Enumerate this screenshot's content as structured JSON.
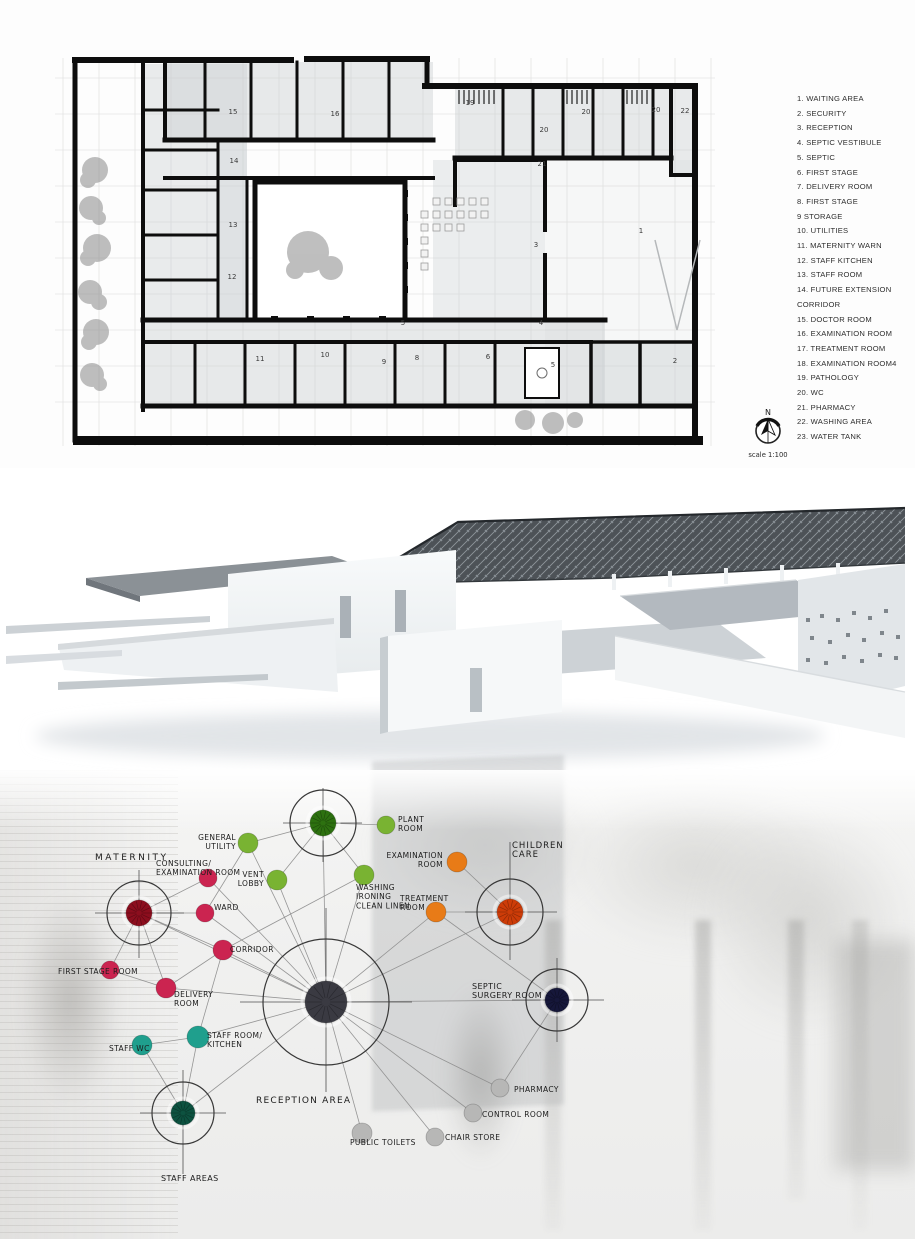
{
  "legend": {
    "items": [
      "1. WAITING AREA",
      "2. SECURITY",
      "3. RECEPTION",
      "4. SEPTIC VESTIBULE",
      "5. SEPTIC",
      "6. FIRST STAGE",
      "7. DELIVERY ROOM",
      "8. FIRST STAGE",
      "9 STORAGE",
      "10.  UTILITIES",
      "11. MATERNITY WARN",
      "12. STAFF KITCHEN",
      "13. STAFF ROOM",
      "14. FUTURE EXTENSION\nCORRIDOR",
      "15. DOCTOR ROOM",
      "16. EXAMINATION ROOM",
      "17. TREATMENT ROOM",
      "18. EXAMINATION ROOM4",
      "19. PATHOLOGY",
      "20. WC",
      "21. PHARMACY",
      "22. WASHING AREA",
      "23. WATER TANK"
    ]
  },
  "north_arrow": {
    "label": "N",
    "scale_text": "scale 1:100"
  },
  "floor_plan": {
    "room_numbers": [
      {
        "n": "15",
        "x": 178,
        "y": 84
      },
      {
        "n": "16",
        "x": 280,
        "y": 86
      },
      {
        "n": "14",
        "x": 179,
        "y": 133
      },
      {
        "n": "13",
        "x": 178,
        "y": 197
      },
      {
        "n": "12",
        "x": 177,
        "y": 249
      },
      {
        "n": "19",
        "x": 415,
        "y": 75
      },
      {
        "n": "20",
        "x": 489,
        "y": 102
      },
      {
        "n": "20",
        "x": 531,
        "y": 84
      },
      {
        "n": "20",
        "x": 601,
        "y": 82
      },
      {
        "n": "21",
        "x": 487,
        "y": 136
      },
      {
        "n": "22",
        "x": 630,
        "y": 83
      },
      {
        "n": "1",
        "x": 586,
        "y": 203
      },
      {
        "n": "3",
        "x": 481,
        "y": 217
      },
      {
        "n": "5",
        "x": 348,
        "y": 295
      },
      {
        "n": "4",
        "x": 486,
        "y": 295
      },
      {
        "n": "11",
        "x": 205,
        "y": 331
      },
      {
        "n": "10",
        "x": 270,
        "y": 327
      },
      {
        "n": "9",
        "x": 329,
        "y": 334
      },
      {
        "n": "8",
        "x": 362,
        "y": 330
      },
      {
        "n": "6",
        "x": 433,
        "y": 329
      },
      {
        "n": "5",
        "x": 498,
        "y": 337
      },
      {
        "n": "2",
        "x": 620,
        "y": 333
      }
    ]
  },
  "bubble_diagram": {
    "colors": {
      "green": "#79b332",
      "red": "#cb2450",
      "orange": "#e87b17",
      "teal": "#1f9f8d",
      "gray": "#b7b7b6",
      "hub_green": "#2d7110",
      "hub_red": "#8c0e1e",
      "hub_orange": "#cd3c08",
      "hub_navy": "#16173a",
      "hub_teal": "#0d5240",
      "hub_charcoal": "#3a3a42"
    },
    "nodes": [
      {
        "id": "utility-hub",
        "hub": true,
        "x": 323,
        "y": 53,
        "r": 13,
        "color": "#2d7110",
        "ring": 33,
        "cross": {
          "v": [
            18,
            92
          ],
          "h": [
            283,
            362
          ]
        }
      },
      {
        "id": "plant-room",
        "x": 386,
        "y": 55,
        "r": 9,
        "color": "#79b332",
        "label": [
          "PLANT",
          "ROOM"
        ],
        "lx": 398,
        "ly": 52,
        "anchor": "start"
      },
      {
        "id": "general-utility",
        "x": 248,
        "y": 73,
        "r": 10,
        "color": "#79b332",
        "label": [
          "GENERAL",
          "UTILITY"
        ],
        "lx": 236,
        "ly": 70,
        "anchor": "end"
      },
      {
        "id": "vent-lobby",
        "x": 277,
        "y": 110,
        "r": 10,
        "color": "#79b332",
        "label": [
          "VENT",
          "LOBBY"
        ],
        "lx": 264,
        "ly": 107,
        "anchor": "end"
      },
      {
        "id": "washing",
        "x": 364,
        "y": 105,
        "r": 10,
        "color": "#79b332",
        "label": [
          "WASHING",
          "IRONING",
          "CLEAN LINEN"
        ],
        "lx": 356,
        "ly": 120,
        "anchor": "start"
      },
      {
        "id": "examination-room",
        "x": 457,
        "y": 92,
        "r": 10,
        "color": "#e87b17",
        "label": [
          "EXAMINATION",
          "ROOM"
        ],
        "lx": 443,
        "ly": 88,
        "anchor": "end"
      },
      {
        "id": "children-care",
        "hub": true,
        "x": 510,
        "y": 142,
        "r": 13,
        "color": "#cd3c08",
        "ring": 33,
        "cross": {
          "v": [
            72,
            190
          ],
          "h": [
            465,
            557
          ]
        },
        "label": [
          "CHILDREN",
          "CARE"
        ],
        "lx": 512,
        "ly": 78,
        "anchor": "start",
        "fs": 8.5,
        "ls": 1
      },
      {
        "id": "treatment-room",
        "x": 436,
        "y": 142,
        "r": 10,
        "color": "#e87b17",
        "label": [
          "TREATMENT",
          "ROOM"
        ],
        "lx": 400,
        "ly": 131,
        "anchor": "start"
      },
      {
        "id": "septic-surgery",
        "hub": true,
        "x": 557,
        "y": 230,
        "r": 12,
        "color": "#16173a",
        "ring": 31,
        "cross": {
          "v": [
            188,
            272
          ],
          "h": [
            512,
            604
          ]
        },
        "label": [
          "SEPTIC",
          "SURGERY ROOM"
        ],
        "lx": 472,
        "ly": 219,
        "anchor": "start",
        "fs": 8
      },
      {
        "id": "maternity",
        "hub": true,
        "x": 139,
        "y": 143,
        "r": 13,
        "color": "#8c0e1e",
        "ring": 32,
        "cross": {
          "v": [
            100,
            188
          ],
          "h": [
            95,
            184
          ]
        },
        "label": [
          "MATERNITY"
        ],
        "lx": 95,
        "ly": 90,
        "anchor": "start",
        "fs": 9,
        "ls": 2.5
      },
      {
        "id": "consulting-exam",
        "x": 208,
        "y": 108,
        "r": 9,
        "color": "#cb2450",
        "label": [
          "CONSULTING/",
          "EXAMINATION ROOM"
        ],
        "lx": 156,
        "ly": 96,
        "anchor": "start"
      },
      {
        "id": "ward",
        "x": 205,
        "y": 143,
        "r": 9,
        "color": "#cb2450",
        "label": [
          "WARD"
        ],
        "lx": 214,
        "ly": 140,
        "anchor": "start"
      },
      {
        "id": "corridor",
        "x": 223,
        "y": 180,
        "r": 10,
        "color": "#cb2450",
        "label": [
          "CORRIDOR"
        ],
        "lx": 230,
        "ly": 182,
        "anchor": "start"
      },
      {
        "id": "first-stage",
        "x": 110,
        "y": 200,
        "r": 9,
        "color": "#cb2450",
        "label": [
          "FIRST STAGE ROOM"
        ],
        "lx": 58,
        "ly": 204,
        "anchor": "start"
      },
      {
        "id": "delivery",
        "x": 166,
        "y": 218,
        "r": 10,
        "color": "#cb2450",
        "label": [
          "DELIVERY",
          "ROOM"
        ],
        "lx": 174,
        "ly": 227,
        "anchor": "start"
      },
      {
        "id": "staff-wc",
        "x": 142,
        "y": 275,
        "r": 10,
        "color": "#1f9f8d",
        "label": [
          "STAFF WC"
        ],
        "lx": 109,
        "ly": 281,
        "anchor": "start"
      },
      {
        "id": "staff-kitchen",
        "x": 198,
        "y": 267,
        "r": 11,
        "color": "#1f9f8d",
        "label": [
          "STAFF ROOM/",
          "KITCHEN"
        ],
        "lx": 207,
        "ly": 268,
        "anchor": "start"
      },
      {
        "id": "staff-areas",
        "hub": true,
        "x": 183,
        "y": 343,
        "r": 12,
        "color": "#0d5240",
        "ring": 31,
        "cross": {
          "v": [
            300,
            404
          ],
          "h": [
            140,
            226
          ]
        },
        "label": [
          "STAFF AREAS"
        ],
        "lx": 161,
        "ly": 411,
        "anchor": "start",
        "fs": 8
      },
      {
        "id": "reception",
        "hub": true,
        "x": 326,
        "y": 232,
        "r": 21,
        "color": "#3a3a42",
        "ring": 63,
        "cross": {
          "v": [
            138,
            322
          ],
          "h": [
            240,
            412
          ]
        },
        "label": [
          "RECEPTION AREA"
        ],
        "lx": 256,
        "ly": 333,
        "anchor": "start",
        "fs": 9,
        "ls": 1.2
      },
      {
        "id": "pharmacy",
        "x": 500,
        "y": 318,
        "r": 9,
        "color": "#b7b7b6",
        "label": [
          "PHARMACY"
        ],
        "lx": 514,
        "ly": 322,
        "anchor": "start"
      },
      {
        "id": "control-room",
        "x": 473,
        "y": 343,
        "r": 9,
        "color": "#b7b7b6",
        "label": [
          "CONTROL ROOM"
        ],
        "lx": 482,
        "ly": 347,
        "anchor": "start"
      },
      {
        "id": "chair-store",
        "x": 435,
        "y": 367,
        "r": 9,
        "color": "#b7b7b6",
        "label": [
          "CHAIR STORE"
        ],
        "lx": 445,
        "ly": 370,
        "anchor": "start"
      },
      {
        "id": "public-toilets",
        "x": 362,
        "y": 363,
        "r": 10,
        "color": "#b7b7b6",
        "label": [
          "PUBLIC TOILETS"
        ],
        "lx": 350,
        "ly": 375,
        "anchor": "start"
      }
    ],
    "edges": [
      [
        "reception",
        "maternity"
      ],
      [
        "reception",
        "consulting-exam"
      ],
      [
        "reception",
        "ward"
      ],
      [
        "reception",
        "corridor"
      ],
      [
        "reception",
        "delivery"
      ],
      [
        "reception",
        "general-utility"
      ],
      [
        "reception",
        "vent-lobby"
      ],
      [
        "reception",
        "utility-hub"
      ],
      [
        "reception",
        "washing"
      ],
      [
        "reception",
        "treatment-room"
      ],
      [
        "reception",
        "children-care"
      ],
      [
        "reception",
        "septic-surgery"
      ],
      [
        "reception",
        "pharmacy"
      ],
      [
        "reception",
        "control-room"
      ],
      [
        "reception",
        "chair-store"
      ],
      [
        "reception",
        "public-toilets"
      ],
      [
        "reception",
        "staff-kitchen"
      ],
      [
        "reception",
        "staff-areas"
      ],
      [
        "maternity",
        "consulting-exam"
      ],
      [
        "maternity",
        "ward"
      ],
      [
        "maternity",
        "corridor"
      ],
      [
        "maternity",
        "first-stage"
      ],
      [
        "maternity",
        "delivery"
      ],
      [
        "first-stage",
        "delivery"
      ],
      [
        "delivery",
        "corridor"
      ],
      [
        "utility-hub",
        "general-utility"
      ],
      [
        "utility-hub",
        "plant-room"
      ],
      [
        "utility-hub",
        "vent-lobby"
      ],
      [
        "utility-hub",
        "washing"
      ],
      [
        "general-utility",
        "ward"
      ],
      [
        "washing",
        "corridor"
      ],
      [
        "corridor",
        "staff-kitchen"
      ],
      [
        "examination-room",
        "children-care"
      ],
      [
        "treatment-room",
        "children-care"
      ],
      [
        "treatment-room",
        "septic-surgery"
      ],
      [
        "pharmacy",
        "septic-surgery"
      ],
      [
        "staff-areas",
        "staff-wc"
      ],
      [
        "staff-areas",
        "staff-kitchen"
      ],
      [
        "staff-wc",
        "staff-kitchen"
      ]
    ]
  }
}
